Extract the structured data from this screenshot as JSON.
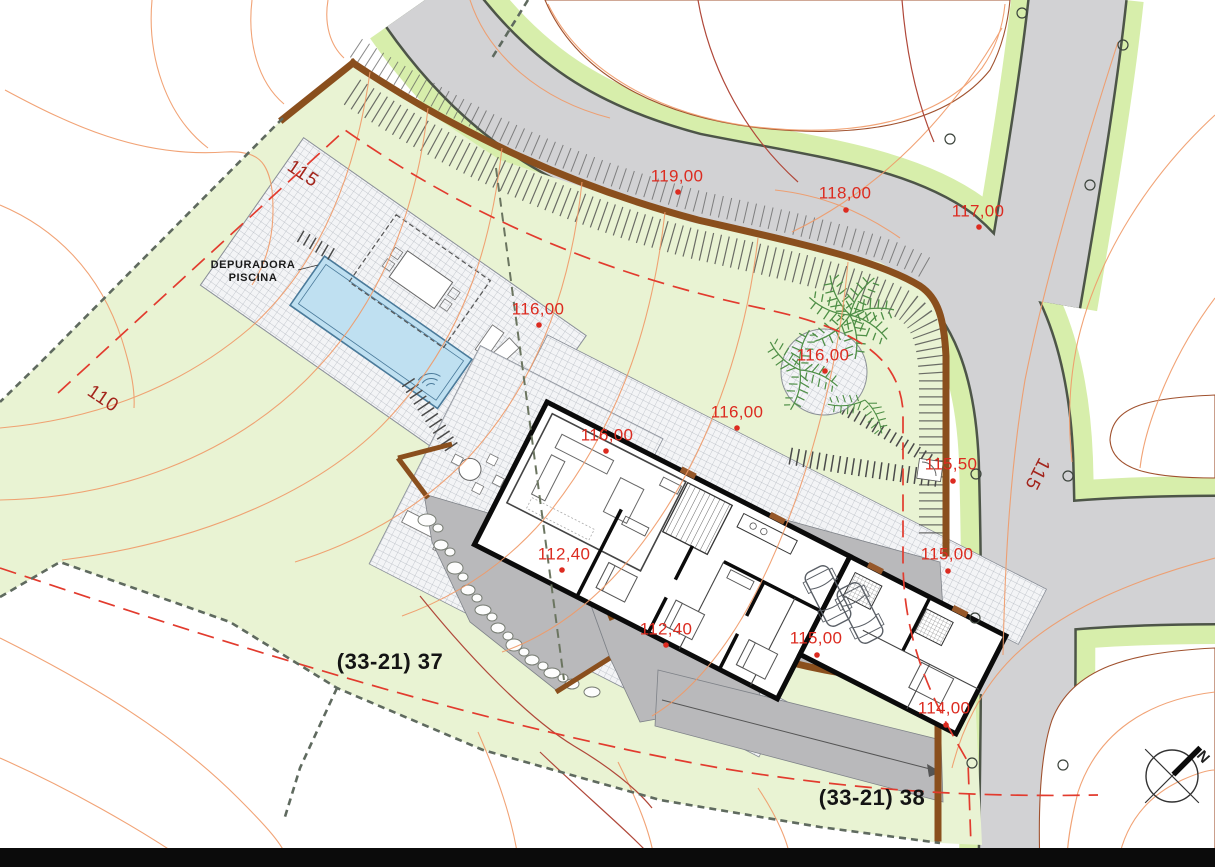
{
  "plan": {
    "plot_labels": {
      "plot_37": "(33-21) 37",
      "plot_38": "(33-21) 38"
    },
    "elevation_labels": [
      "119,00",
      "118,00",
      "117,00",
      "116,00",
      "116,00",
      "116,00",
      "116,00",
      "115,50",
      "115,00",
      "112,40",
      "112,40",
      "115,00",
      "114,00"
    ],
    "contour_labels": {
      "c115_left": "115",
      "c110": "110",
      "c115_road": "115"
    },
    "pool_equipment_note": {
      "line1": "DEPURADORA",
      "line2": "PISCINA"
    },
    "compass_north": "N",
    "colors": {
      "plot_green": "#e9f3d3",
      "road_verge_green": "#d7eeab",
      "road_gray": "#d2d2d4",
      "patio_gray": "#b9b9bb",
      "pool_blue": "#bfe0f1",
      "retaining_wall_brown": "#8a4f1d",
      "elevation_label_red": "#dc2b20",
      "contour_label_red": "#a3251c",
      "contour_line_orange": "#f09a68",
      "plot_boundary_gray": "#5f6a5f",
      "text_black": "#141414"
    }
  }
}
